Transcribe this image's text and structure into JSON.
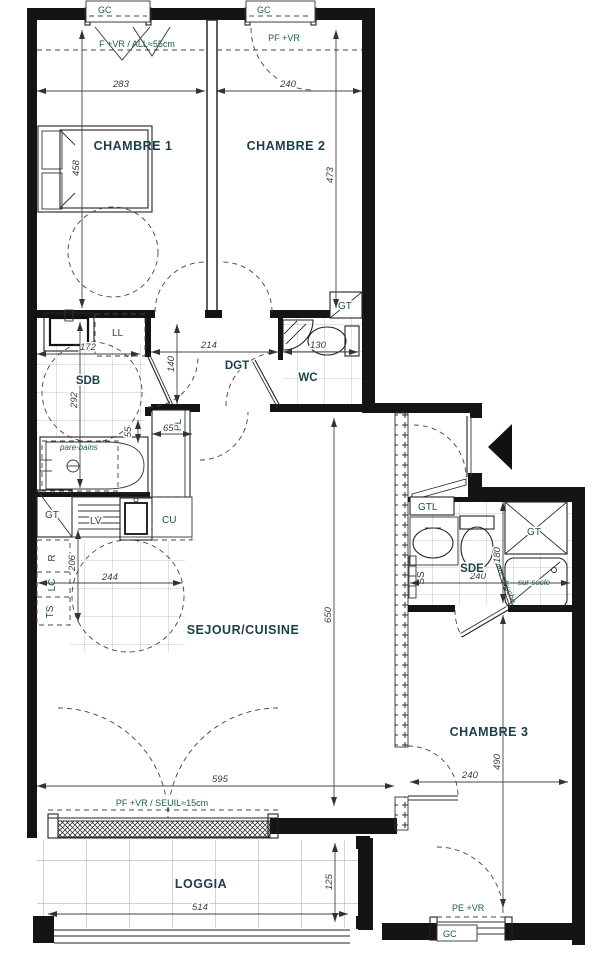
{
  "rooms": {
    "chambre1": "CHAMBRE 1",
    "chambre2": "CHAMBRE 2",
    "chambre3": "CHAMBRE 3",
    "sejour": "SEJOUR/CUISINE",
    "sdb": "SDB",
    "wc": "WC",
    "dgt": "DGT",
    "sde": "SDE",
    "loggia": "LOGGIA"
  },
  "dims": {
    "d283": "283",
    "d240": "240",
    "d458": "458",
    "d473": "473",
    "d172": "172",
    "d292": "292",
    "d214": "214",
    "d140": "140",
    "d130": "130",
    "d65": "65",
    "d55": "55",
    "d206": "206",
    "d244": "244",
    "d650": "650",
    "d595": "595",
    "d514": "514",
    "d125": "125",
    "d490": "490",
    "d180": "180"
  },
  "ann": {
    "gc": "GC",
    "window_ch1": "F +VR / ALL≈55cm",
    "window_ch2": "PF +VR",
    "bay_window": "PF +VR / SEUIL≈15cm",
    "door_ch3": "PE +VR",
    "gt": "GT",
    "gtl": "GTL",
    "ll": "LL",
    "lv": "LV",
    "cu": "CU",
    "r": "R",
    "lc": "LC",
    "ts": "TS",
    "ss": "SS",
    "pl": "PL",
    "pare_bains": "pare-bains",
    "pare_douche": "pare-douche",
    "sur_socle": "sur socle"
  }
}
